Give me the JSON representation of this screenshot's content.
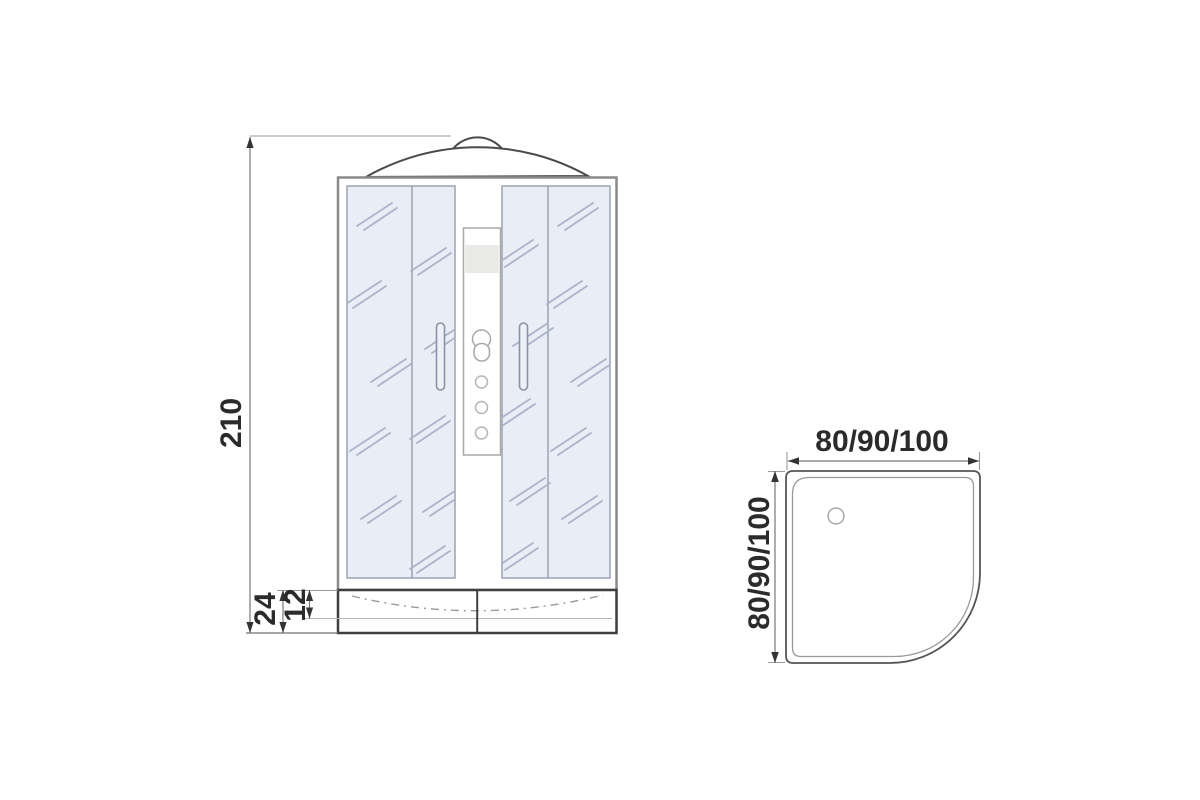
{
  "page": {
    "type": "technical drawing — shower cabin with dimensions",
    "background": "#ffffff"
  },
  "front_view": {
    "name": "front elevation of shower cabin",
    "overall_height": "210",
    "tray_height": "24",
    "tray_basin_depth": "12"
  },
  "plan_view": {
    "name": "plan view of quarter-round shower tray",
    "width_options": "80/90/100",
    "depth_options": "80/90/100"
  },
  "colors": {
    "outline_dark": "#3f3f3f",
    "frame_gray": "#8a8a8a",
    "glass_fill": "#e9edf6",
    "glass_stroke": "#9aa3b2",
    "hatch": "#aab4c8",
    "dim_line": "#777777",
    "arrow": "#333333",
    "ext_line": "#9a9a9a",
    "band_fill": "#e9e9e5",
    "control_stroke": "#a8a8a8",
    "text": "#2b2b2b"
  }
}
